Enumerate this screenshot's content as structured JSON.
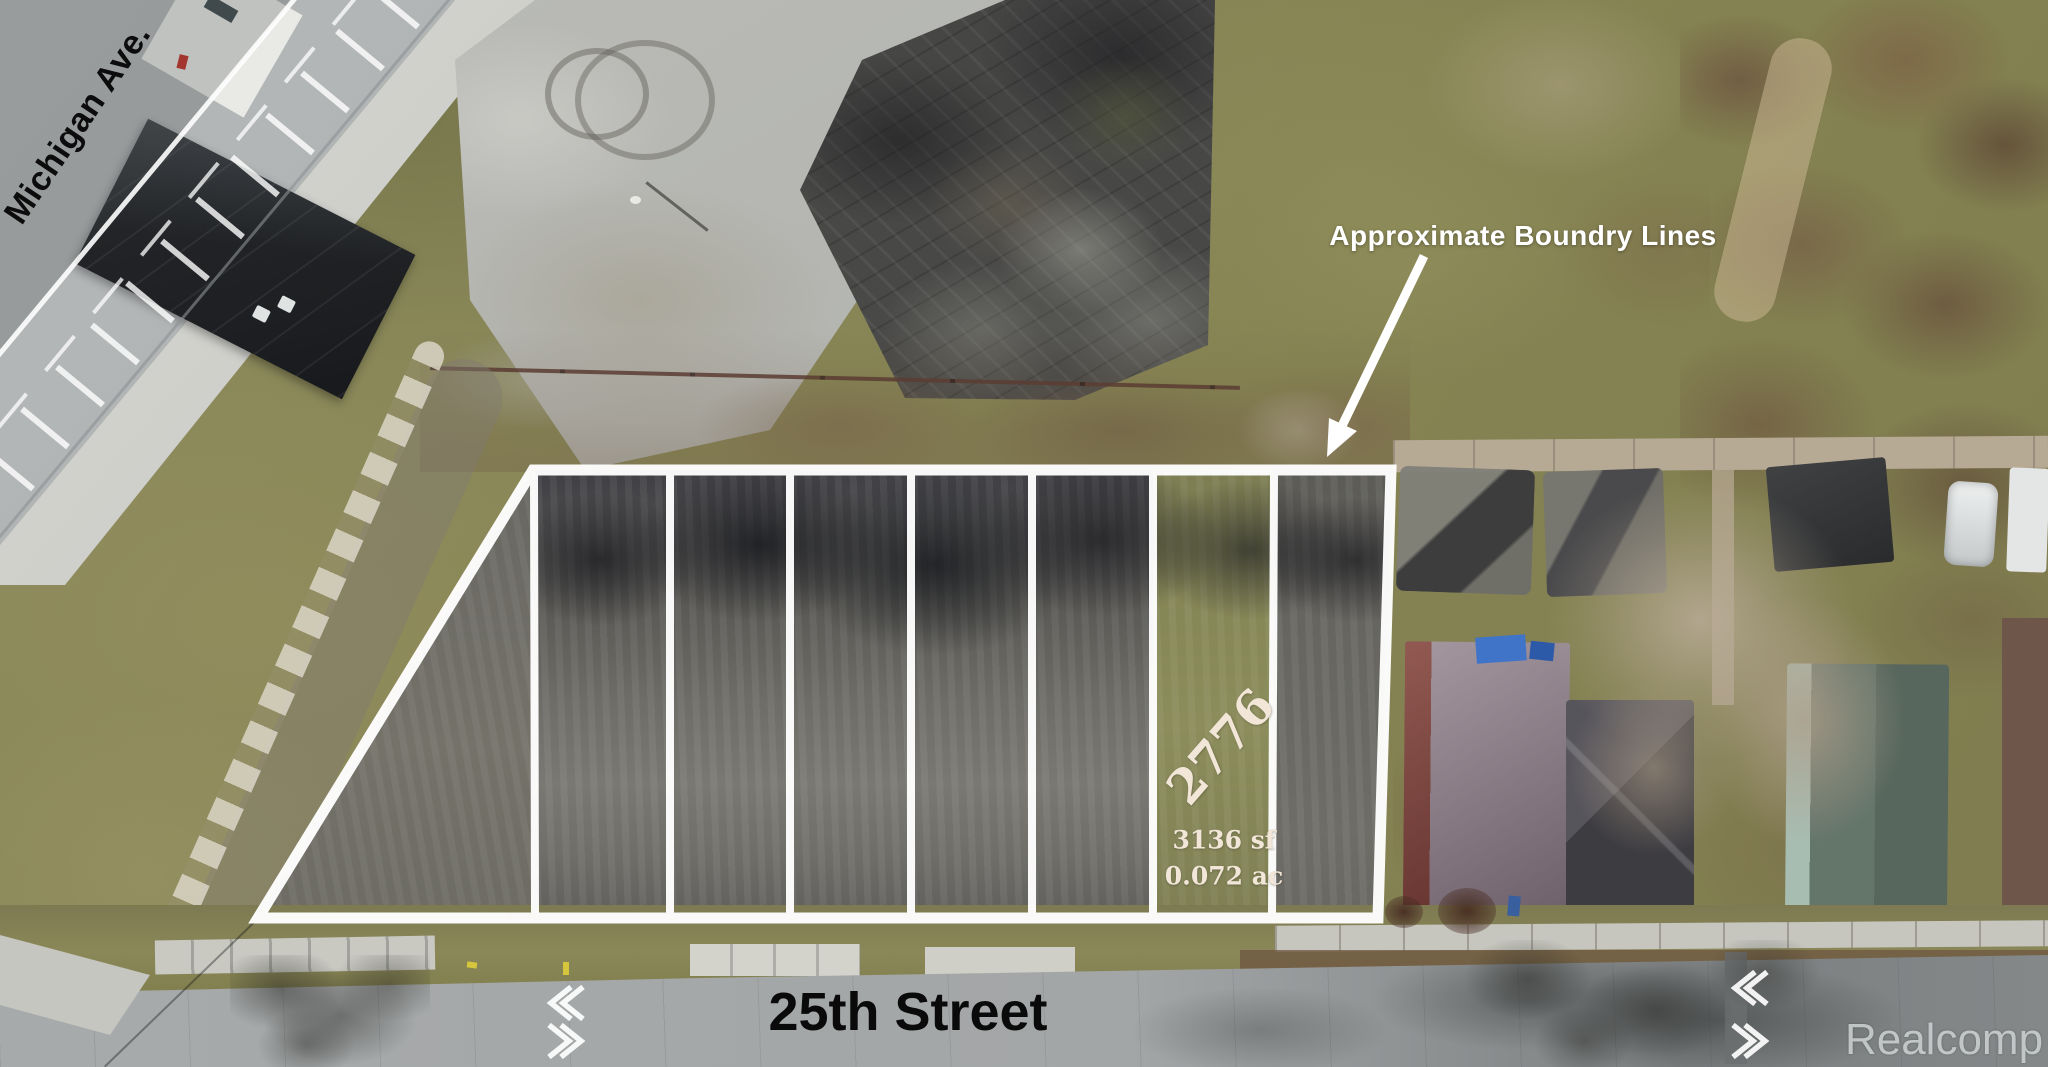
{
  "scene": {
    "road_left_label": "Michigan Ave.",
    "street_bottom_label": "25th Street",
    "boundary_note": "Approximate Boundry Lines",
    "lot_highlight": {
      "number": "2776",
      "area_sqft": "3136 sf",
      "area_acres": "0.072 ac"
    },
    "parcel_strip_count": 7,
    "watermark": "Realcomp"
  },
  "colors": {
    "boundary_line": "#ffffff",
    "annotation_text": "#ffffff",
    "street_label_text": "#0b0b0b",
    "lot_label_text": "#f2e6d8",
    "watermark_text": "#ccd1d3",
    "grass_olive": "#8c8a5f",
    "asphalt_gray": "#a8abac",
    "rubble_dark": "#4a4a48"
  },
  "icons": {
    "boundary_arrow": "arrow-pointing-to-parcels",
    "lane_chevron_up": "chevron-left",
    "lane_chevron_down": "chevron-right"
  }
}
